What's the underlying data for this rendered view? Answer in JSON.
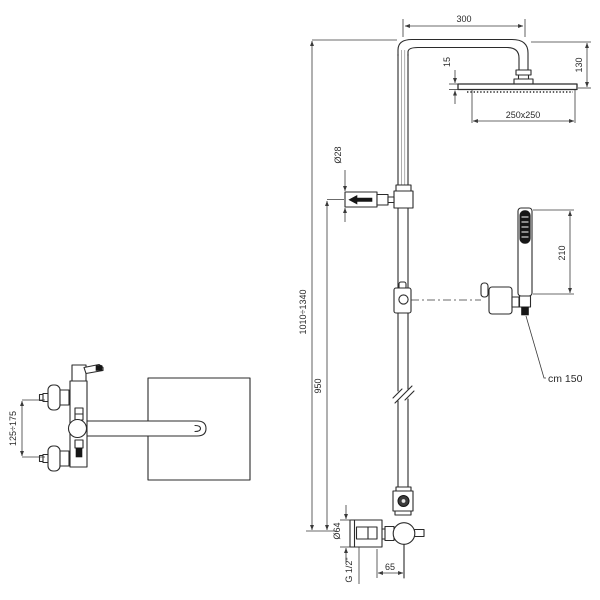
{
  "drawing": {
    "type": "technical-installation-drawing",
    "subject": "shower-column-with-rain-head-hand-shower-and-wall-mixer",
    "background_color": "#ffffff",
    "line_color": "#2b2b2b",
    "dimension_color": "#3a3a3a",
    "dimensions": {
      "arm_reach": "300",
      "head_drop": "130",
      "head_thickness": "15",
      "head_size": "250x250",
      "riser_diameter": "Ø28",
      "total_height": "1010÷1340",
      "lower_section": "950",
      "handshower_length": "210",
      "hose_length": "cm 150",
      "escutcheon_diameter": "Ø64",
      "connection_thread": "G 1/2\"",
      "wall_offset": "65",
      "inlet_spacing": "125÷175"
    }
  }
}
